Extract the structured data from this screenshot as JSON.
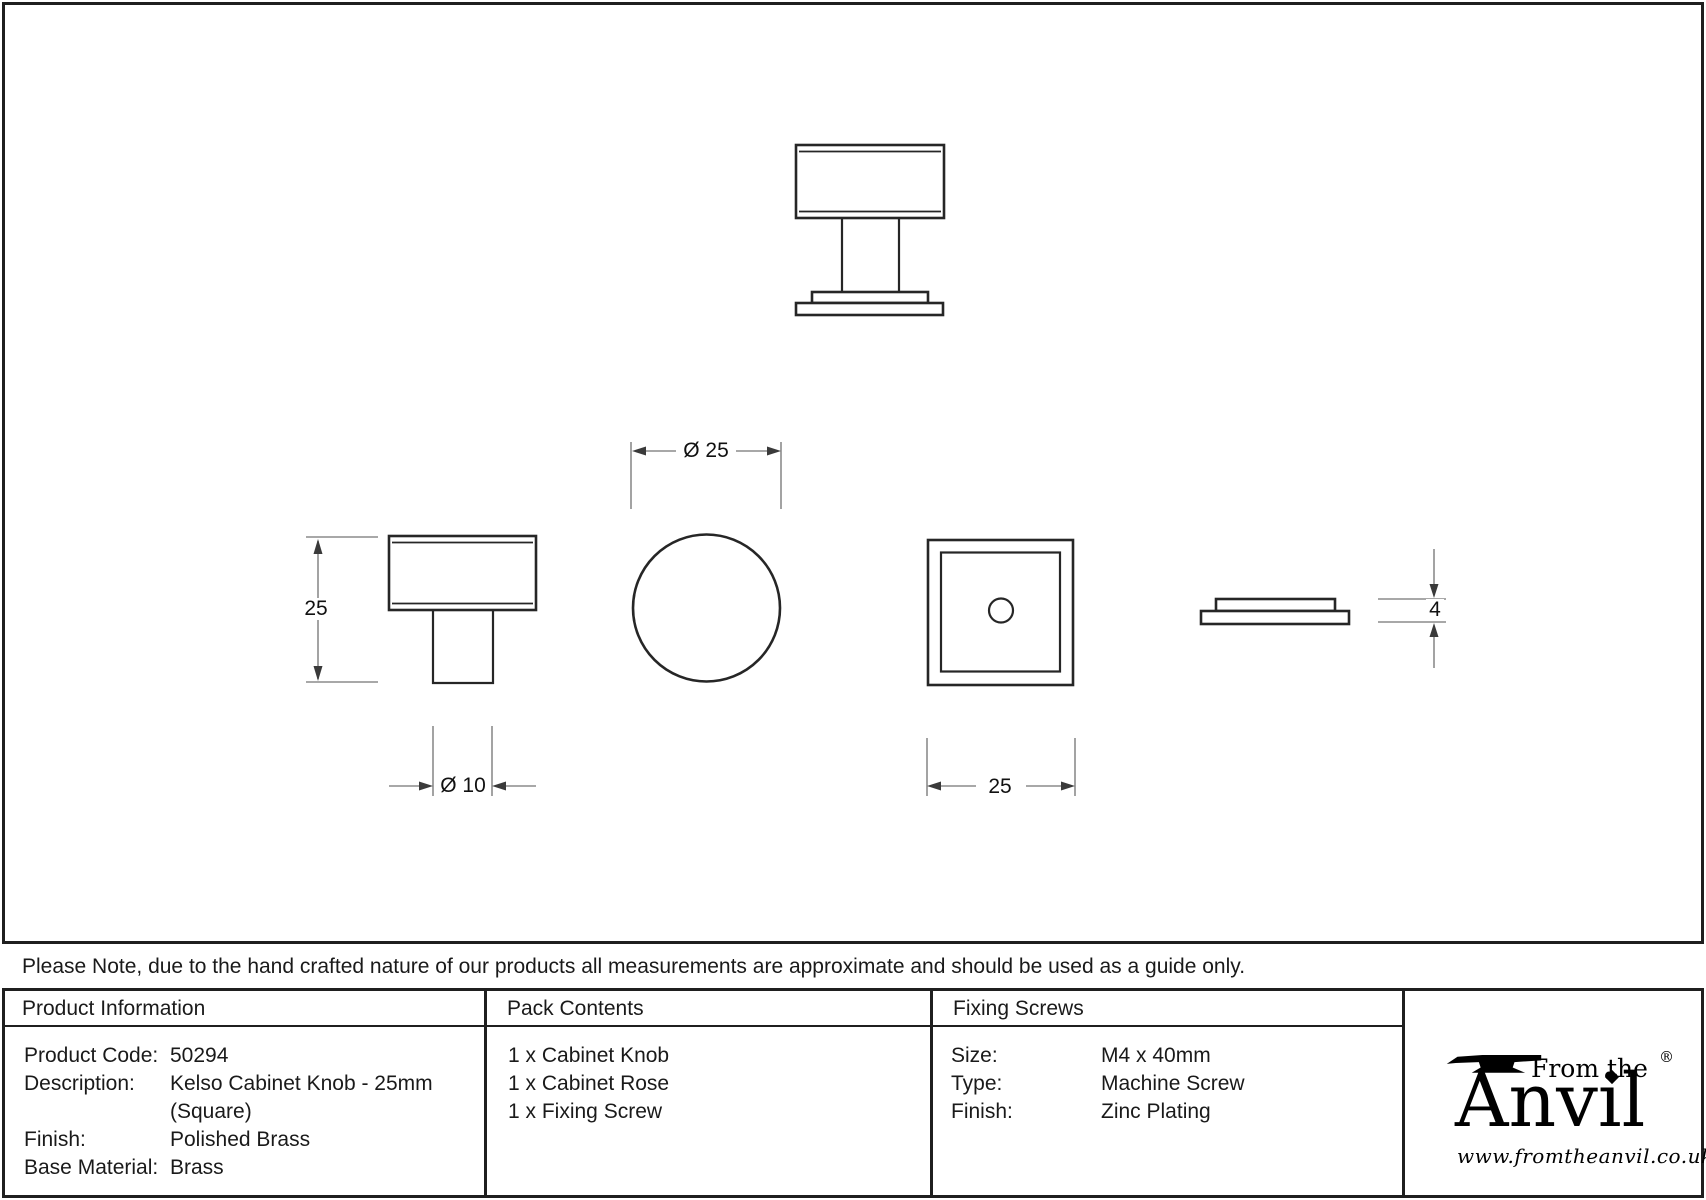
{
  "note": "Please Note, due to the hand crafted nature of our products all measurements are approximate and should be used as a guide only.",
  "drawing": {
    "dim_knob_height": "25",
    "dim_stem_diameter": "Ø 10",
    "dim_knob_diameter": "Ø 25",
    "dim_knob_width": "25",
    "dim_rose_thickness": "4"
  },
  "table": {
    "product_information": {
      "header": "Product Information",
      "rows": [
        {
          "label": "Product Code:",
          "value": "50294"
        },
        {
          "label": "Description:",
          "value": "Kelso Cabinet Knob - 25mm (Square)"
        },
        {
          "label": "Finish:",
          "value": "Polished Brass"
        },
        {
          "label": "Base Material:",
          "value": "Brass"
        }
      ]
    },
    "pack_contents": {
      "header": "Pack Contents",
      "items": [
        "1 x Cabinet Knob",
        "1 x Cabinet Rose",
        "1 x Fixing Screw"
      ]
    },
    "fixing_screws": {
      "header": "Fixing Screws",
      "rows": [
        {
          "label": "Size:",
          "value": "M4 x 40mm"
        },
        {
          "label": "Type:",
          "value": "Machine Screw"
        },
        {
          "label": "Finish:",
          "value": "Zinc Plating"
        }
      ]
    }
  },
  "brand": {
    "tagline": "From the",
    "name": "Anvil",
    "registered": "®",
    "url": "www.fromtheanvil.co.uk"
  },
  "colors": {
    "outline": "#262626",
    "dimension": "#8c8c8c",
    "text": "#1a1a1a"
  }
}
